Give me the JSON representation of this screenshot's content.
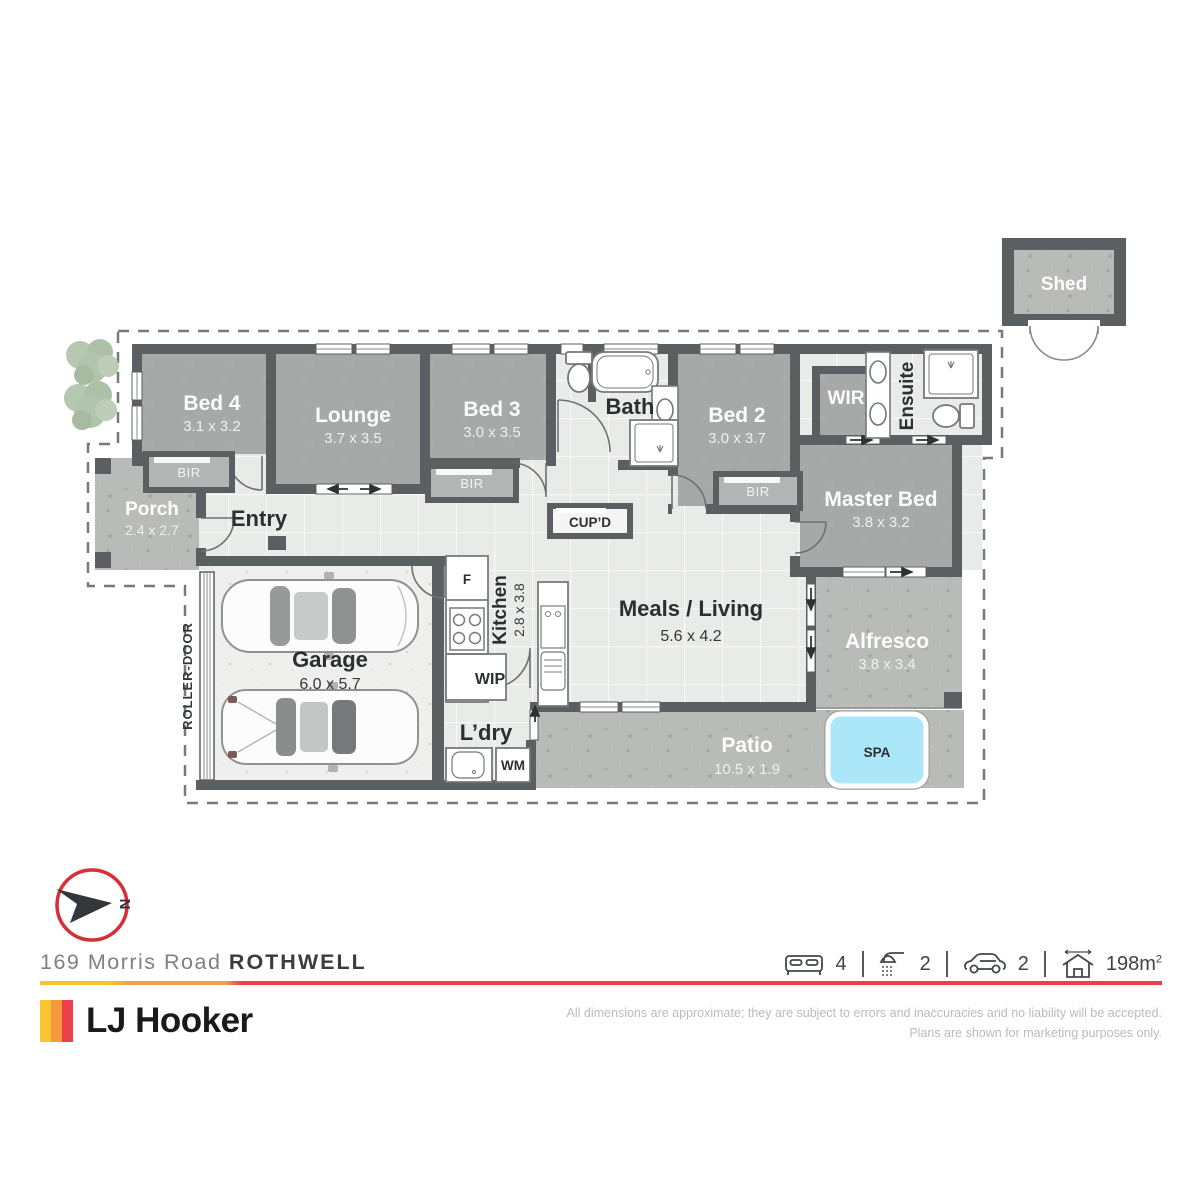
{
  "plan": {
    "rooms": {
      "shed": {
        "name": "Shed"
      },
      "bed4": {
        "name": "Bed 4",
        "dims": "3.1 x 3.2"
      },
      "lounge": {
        "name": "Lounge",
        "dims": "3.7 x 3.5"
      },
      "bed3": {
        "name": "Bed 3",
        "dims": "3.0 x 3.5"
      },
      "bath": {
        "name": "Bath"
      },
      "bed2": {
        "name": "Bed 2",
        "dims": "3.0 x 3.7"
      },
      "wir": {
        "name": "WIR"
      },
      "ensuite": {
        "name": "Ensuite"
      },
      "master_bed": {
        "name": "Master Bed",
        "dims": "3.8 x 3.2"
      },
      "porch": {
        "name": "Porch",
        "dims": "2.4 x 2.7"
      },
      "entry": {
        "name": "Entry"
      },
      "garage": {
        "name": "Garage",
        "dims": "6.0 x 5.7"
      },
      "kitchen": {
        "name": "Kitchen",
        "dims": "2.8 x 3.8"
      },
      "meals_living": {
        "name": "Meals / Living",
        "dims": "5.6 x 4.2"
      },
      "alfresco": {
        "name": "Alfresco",
        "dims": "3.8 x 3.4"
      },
      "patio": {
        "name": "Patio",
        "dims": "10.5 x 1.9"
      },
      "laundry": {
        "name": "L’dry"
      },
      "wip": {
        "name": "WIP"
      },
      "cupboard": {
        "name": "CUP’D"
      },
      "spa": {
        "name": "SPA"
      }
    },
    "fixtures": {
      "bir": "BIR",
      "fridge": "F",
      "washing_machine": "WM",
      "roller_door": "ROLLER-DOOR"
    },
    "compass": {
      "north": "N"
    }
  },
  "footer": {
    "address": {
      "street": "169 Morris Road",
      "suburb": "ROTHWELL"
    },
    "brand": {
      "name": "LJ Hooker"
    },
    "summary": {
      "beds": "4",
      "baths": "2",
      "cars": "2",
      "area": "198m",
      "area_sup": "2"
    },
    "disclaimer": {
      "line1": "All dimensions are approximate; they are subject to errors and inaccuracies and no liability will be accepted.",
      "line2": "Plans are shown for marketing purposes only."
    }
  },
  "colors": {
    "wall": "#5c5f62",
    "spa_blue": "#abe7f8",
    "compass_red": "#d62f35",
    "accent_yellow": "#fcc42f",
    "accent_orange": "#f6993e",
    "accent_red": "#ee3f4d"
  }
}
